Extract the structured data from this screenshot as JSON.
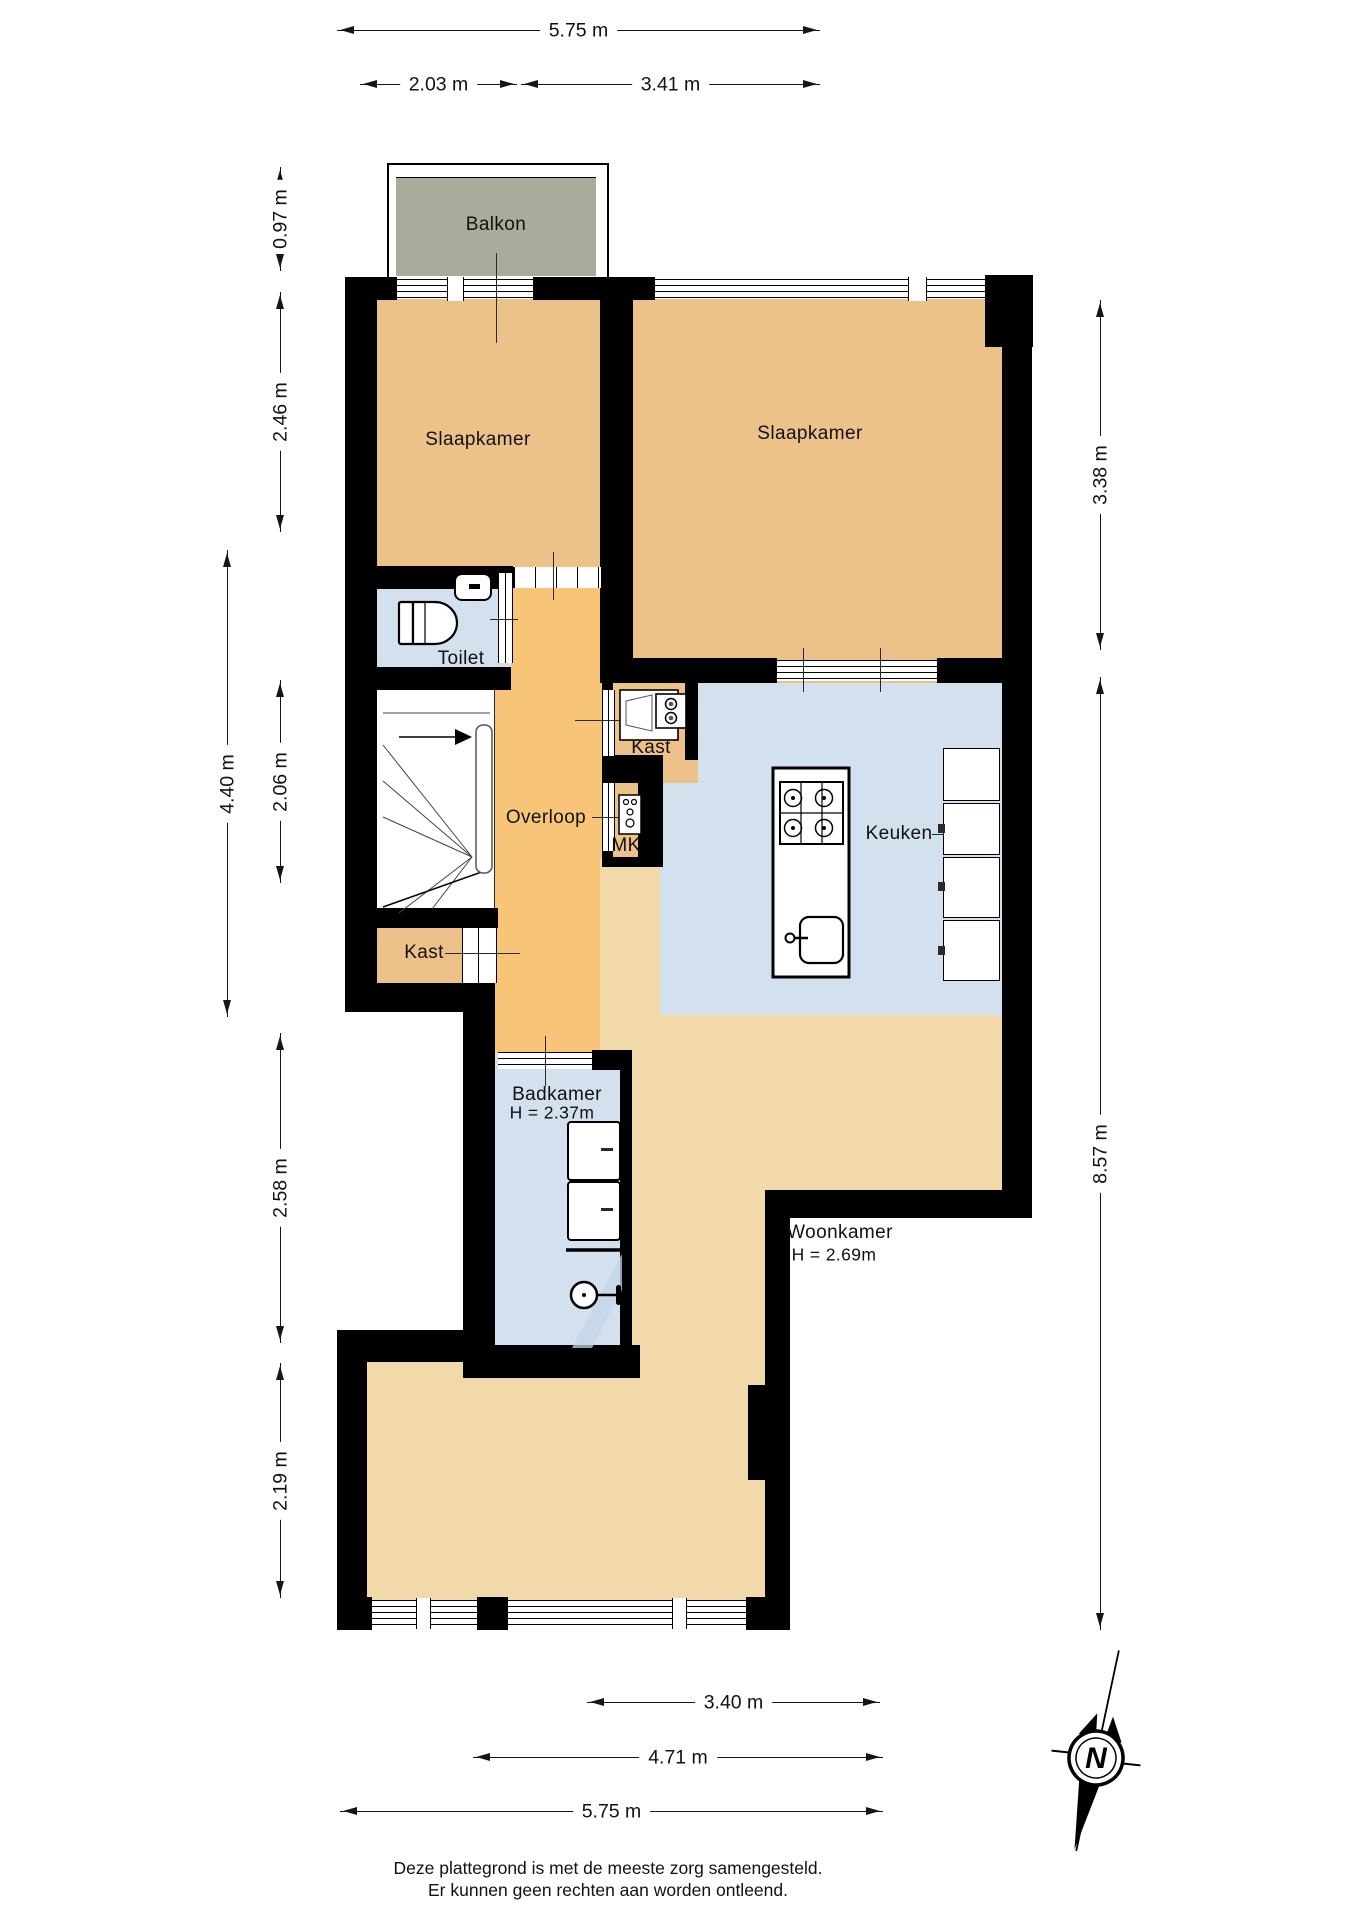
{
  "plan": {
    "type": "floorplan",
    "rooms": {
      "balkon": "Balkon",
      "slaapkamer_left": "Slaapkamer",
      "slaapkamer_right": "Slaapkamer",
      "toilet": "Toilet",
      "overloop": "Overloop",
      "kast_boiler": "Kast",
      "mk": "MK",
      "keuken": "Keuken",
      "kast_under_stairs": "Kast",
      "badkamer": "Badkamer",
      "badkamer_height": "H = 2.37m",
      "woonkamer": "Woonkamer",
      "woonkamer_height": "H = 2.69m"
    },
    "dimensions": {
      "top_total": "5.75 m",
      "top_left": "2.03 m",
      "top_right": "3.41 m",
      "left_balcony": "0.97 m",
      "left_bedroom": "2.46 m",
      "left_outer": "4.40 m",
      "left_middle": "2.06 m",
      "left_bath": "2.58 m",
      "left_bottom": "2.19 m",
      "right_bedroom": "3.38 m",
      "right_total": "8.57 m",
      "bottom_inner": "3.40 m",
      "bottom_middle": "4.71 m",
      "bottom_total": "5.75 m"
    },
    "compass": {
      "north_label": "N"
    },
    "footer": {
      "line1": "Deze plattegrond is met de meeste zorg samengesteld.",
      "line2": "Er kunnen geen rechten aan worden ontleend."
    },
    "colors": {
      "wall": "#000000",
      "bedroom_fill": "#ecc18a",
      "landing_fill": "#f8c478",
      "living_fill": "#f1d9a9",
      "wet_room_fill": "#d3e0ee",
      "balcony_fill": "#a9ac9b"
    }
  }
}
